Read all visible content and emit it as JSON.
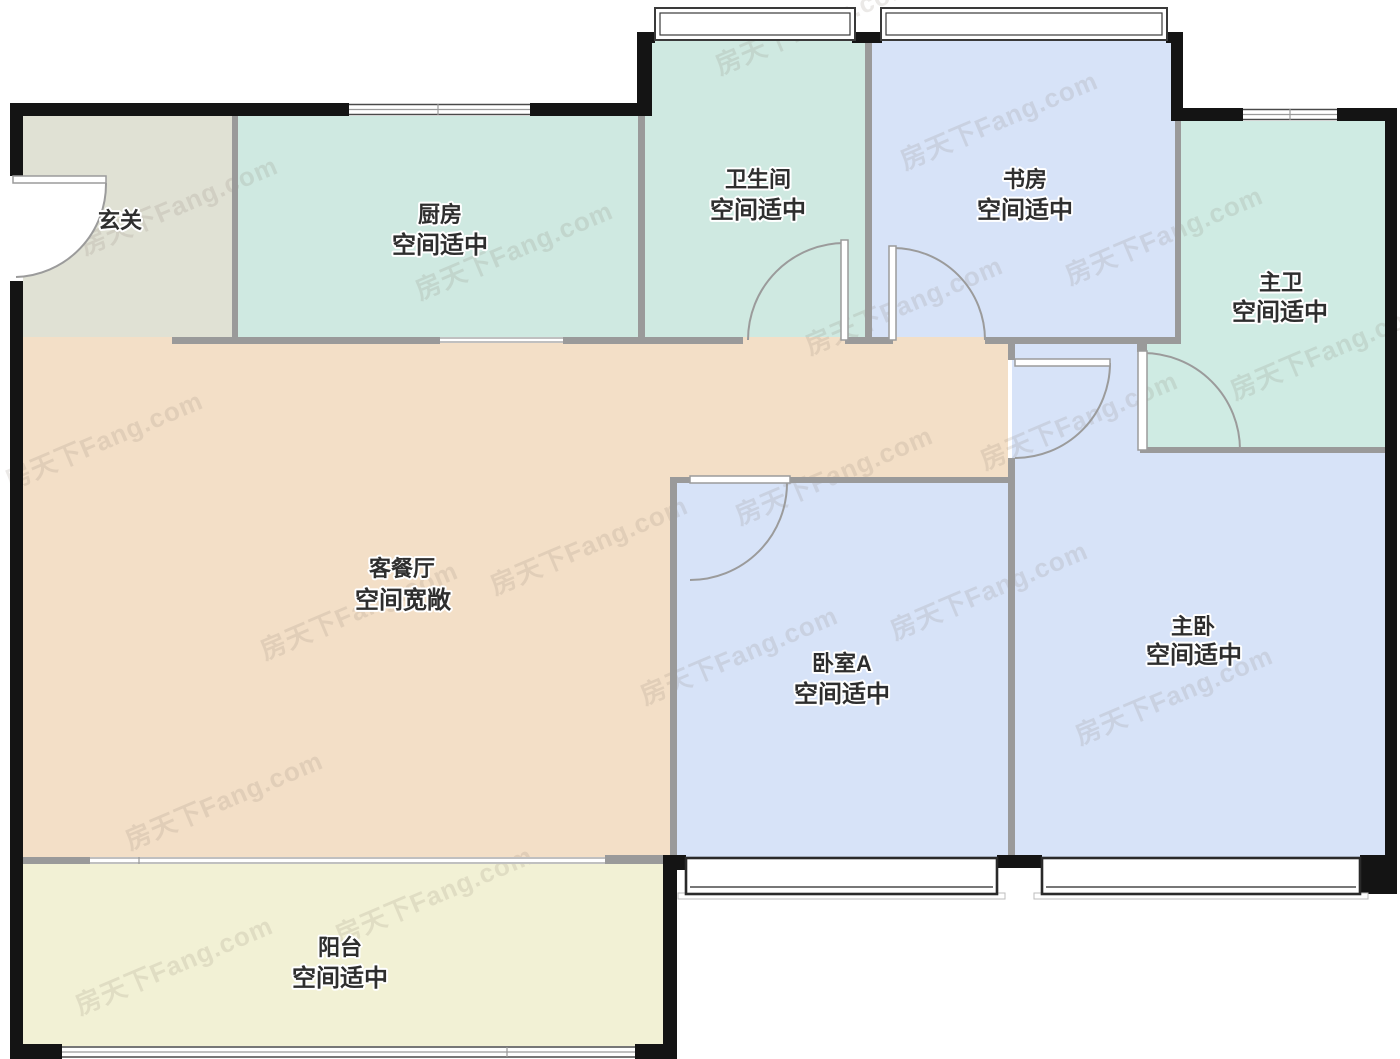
{
  "plan": {
    "watermark_text": "房天下Fang.com",
    "palette": {
      "background": "#ffffff",
      "exterior_wall": "#141414",
      "interior_wall": "#9a9a9a",
      "door_line": "#9b9b9b",
      "label_text": "#2e2e2e"
    },
    "rooms": [
      {
        "id": "entry",
        "name": "玄关",
        "note": "",
        "color": "#e0e1d4"
      },
      {
        "id": "kitchen",
        "name": "厨房",
        "note": "空间适中",
        "color": "#cfe9e1"
      },
      {
        "id": "bathroom",
        "name": "卫生间",
        "note": "空间适中",
        "color": "#cfe9e1"
      },
      {
        "id": "study",
        "name": "书房",
        "note": "空间适中",
        "color": "#d7e3f8"
      },
      {
        "id": "master-bath",
        "name": "主卫",
        "note": "空间适中",
        "color": "#cfebe3"
      },
      {
        "id": "living-dining",
        "name": "客餐厅",
        "note": "空间宽敞",
        "color": "#f3dfc7"
      },
      {
        "id": "bedroom-a",
        "name": "卧室A",
        "note": "空间适中",
        "color": "#d7e3f8"
      },
      {
        "id": "master-bedroom",
        "name": "主卧",
        "note": "空间适中",
        "color": "#d7e3f8"
      },
      {
        "id": "balcony",
        "name": "阳台",
        "note": "空间适中",
        "color": "#f2f1d5"
      }
    ]
  }
}
